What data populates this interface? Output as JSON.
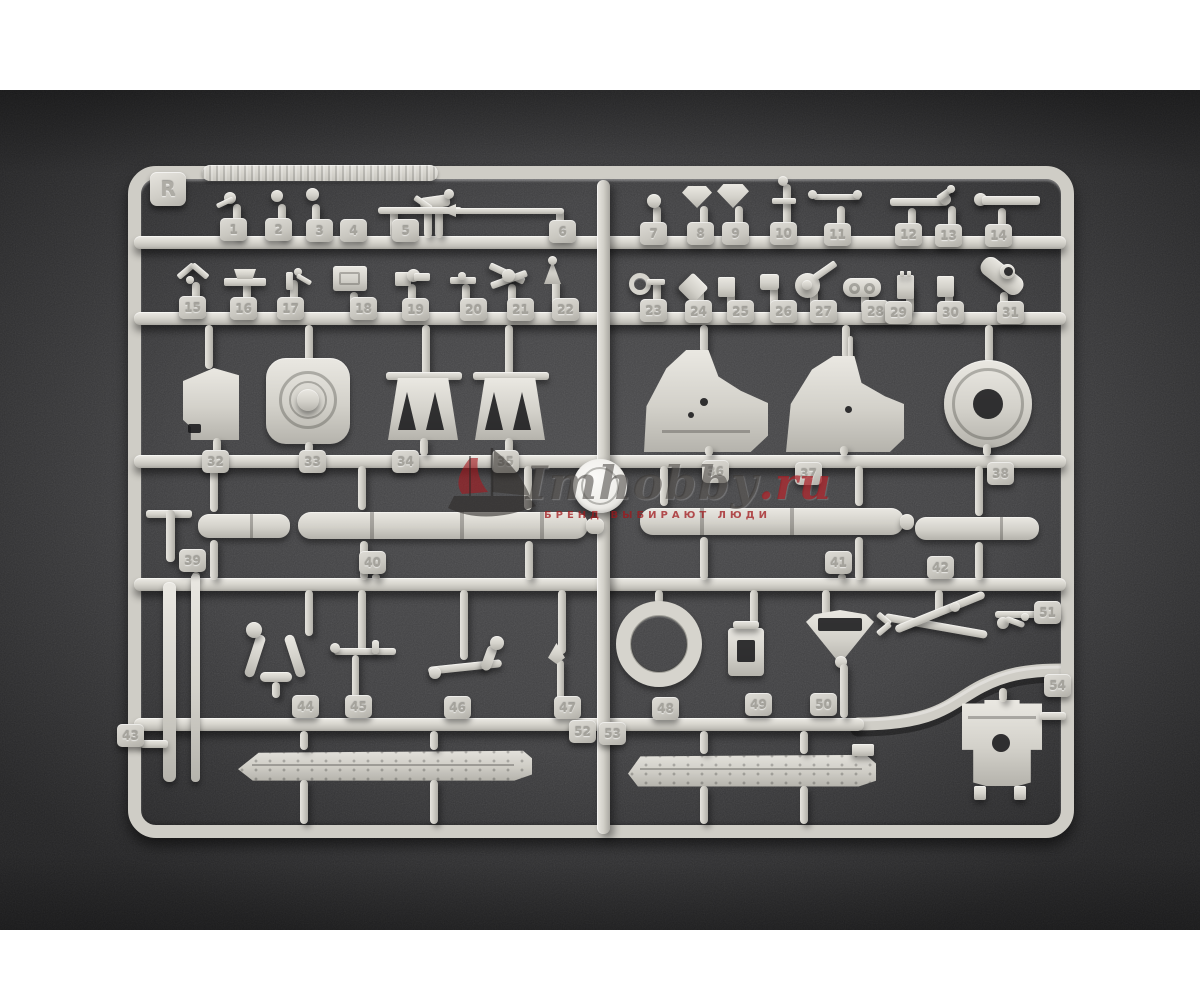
{
  "photo": {
    "sprue": {
      "letter": "R",
      "part_numbers": [
        "1",
        "2",
        "3",
        "4",
        "5",
        "6",
        "7",
        "8",
        "9",
        "10",
        "11",
        "12",
        "13",
        "14",
        "15",
        "16",
        "17",
        "18",
        "19",
        "20",
        "21",
        "22",
        "23",
        "24",
        "25",
        "26",
        "27",
        "28",
        "29",
        "30",
        "31",
        "32",
        "33",
        "34",
        "35",
        "36",
        "37",
        "38",
        "39",
        "40",
        "41",
        "42",
        "43",
        "44",
        "45",
        "46",
        "47",
        "48",
        "49",
        "50",
        "51",
        "52",
        "53",
        "54"
      ]
    },
    "watermark": {
      "brand": "Imhobby",
      "tld": ".ru",
      "tagline": "БРЕНД ВЫБИРАЮТ ЛЮДИ"
    },
    "colors": {
      "backdrop": "#3e3e40",
      "plastic": "#d6d4cd",
      "watermark_red": "#a8212b",
      "photo_border": "#ffffff"
    }
  }
}
